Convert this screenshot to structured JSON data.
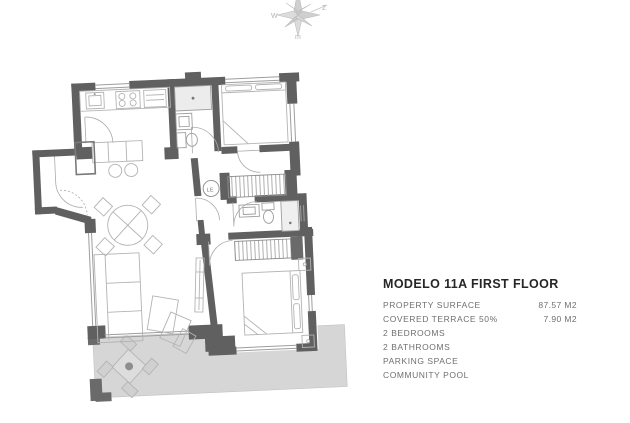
{
  "info_panel": {
    "title": "MODELO 11A FIRST FLOOR",
    "rows": [
      {
        "label": "PROPERTY SURFACE",
        "value": "87.57 M2"
      },
      {
        "label": "COVERED TERRACE 50%",
        "value": "7.90 M2"
      },
      {
        "label": "2 BEDROOMS",
        "value": ""
      },
      {
        "label": "2 BATHROOMS",
        "value": ""
      },
      {
        "label": "PARKING SPACE",
        "value": ""
      },
      {
        "label": "COMMUNITY POOL",
        "value": ""
      }
    ]
  },
  "compass": {
    "letter_left": "W",
    "letter_upper_right": "Z",
    "letter_bottom": "m"
  },
  "floor_plan": {
    "washer_label": "LE",
    "colors": {
      "wall": "#606060",
      "furniture_line": "#b3b3b3",
      "terrace_fill": "#d6d6d6",
      "window_line": "#9d9d9d",
      "title_text": "#262626",
      "spec_text": "#6f6f6f"
    }
  }
}
